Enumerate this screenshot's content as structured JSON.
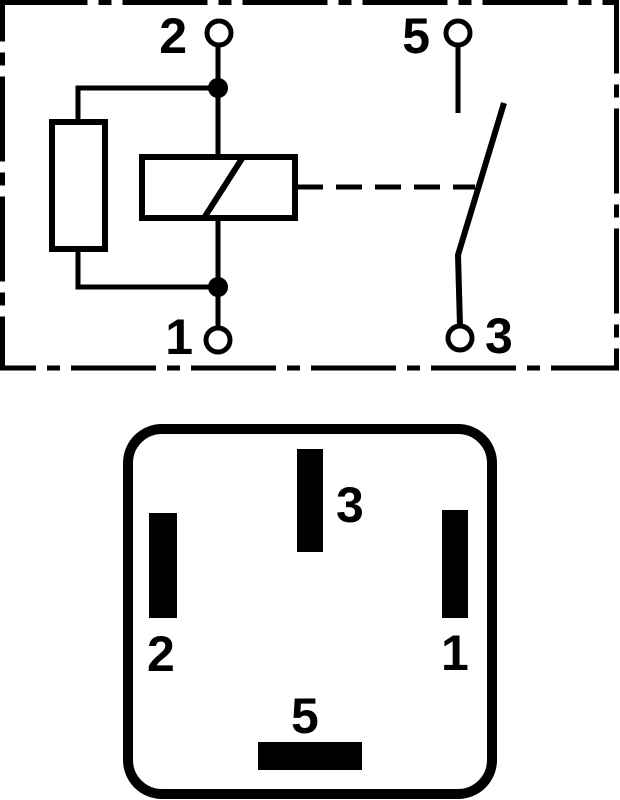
{
  "colors": {
    "ink": "#000000",
    "paper": "#ffffff"
  },
  "schematic": {
    "terminals": {
      "top_left": "2",
      "top_right": "5",
      "bottom_left": "1",
      "bottom_right": "3"
    }
  },
  "socket": {
    "pins": {
      "top": "3",
      "left": "2",
      "right": "1",
      "bottom": "5"
    }
  }
}
